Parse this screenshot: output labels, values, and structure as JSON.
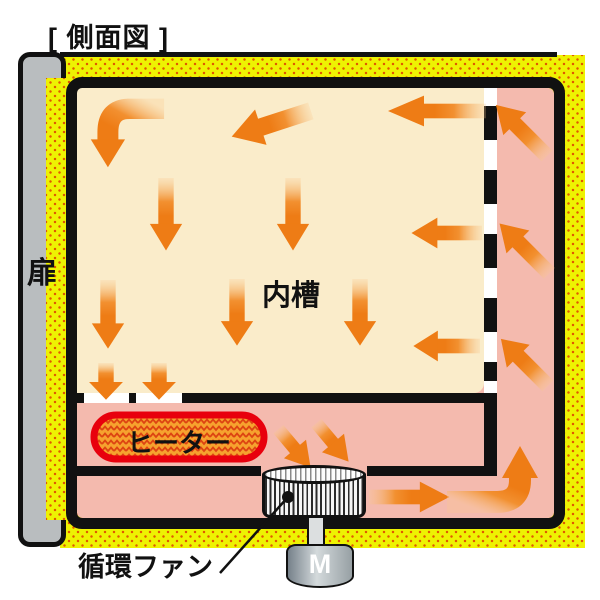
{
  "title": "[ 側面図 ]",
  "labels": {
    "door": "扉",
    "chamber": "内槽",
    "heater": "ヒーター",
    "fan": "循環ファン",
    "motor": "M"
  },
  "colors": {
    "insulation_yellow": "#eef202",
    "insulation_dot_orange": "#e05a00",
    "chamber_cream": "#faecca",
    "air_channel_pink": "#f4baae",
    "arrow_orange": "#ee7c15",
    "arrow_tail_light": "#f9c98e",
    "heater_fill_orange": "#f6a22e",
    "heater_hatch_red": "#dd4412",
    "heater_border_red": "#e8000d",
    "door_gray": "#b9bdbf",
    "wall_black": "#111111",
    "motor_gray": "#97a0a4"
  },
  "arrows": [
    {
      "kind": "bendLD",
      "x": 86,
      "y": 93,
      "w": 80,
      "h": 78,
      "rot": 0
    },
    {
      "kind": "s",
      "cx": 270,
      "cy": 124,
      "len": 85,
      "wid": 46,
      "rot": 162
    },
    {
      "kind": "s",
      "cx": 436,
      "cy": 111,
      "len": 100,
      "wid": 38,
      "rot": 180
    },
    {
      "kind": "s",
      "cx": 166,
      "cy": 215,
      "len": 74,
      "wid": 40,
      "rot": 90
    },
    {
      "kind": "s",
      "cx": 293,
      "cy": 215,
      "len": 74,
      "wid": 40,
      "rot": 90
    },
    {
      "kind": "s",
      "cx": 108,
      "cy": 315,
      "len": 70,
      "wid": 40,
      "rot": 90
    },
    {
      "kind": "s",
      "cx": 237,
      "cy": 313,
      "len": 68,
      "wid": 40,
      "rot": 90
    },
    {
      "kind": "s",
      "cx": 360,
      "cy": 313,
      "len": 68,
      "wid": 40,
      "rot": 90
    },
    {
      "kind": "ss",
      "cx": 106,
      "cy": 382,
      "len": 38,
      "wid": 40,
      "rot": 90
    },
    {
      "kind": "ss",
      "cx": 159,
      "cy": 382,
      "len": 38,
      "wid": 40,
      "rot": 90
    },
    {
      "kind": "s",
      "cx": 446,
      "cy": 233,
      "len": 72,
      "wid": 38,
      "rot": 180
    },
    {
      "kind": "s",
      "cx": 446,
      "cy": 346,
      "len": 68,
      "wid": 38,
      "rot": 180
    },
    {
      "kind": "s",
      "cx": 521,
      "cy": 130,
      "len": 74,
      "wid": 40,
      "rot": 225
    },
    {
      "kind": "s",
      "cx": 524,
      "cy": 248,
      "len": 72,
      "wid": 40,
      "rot": 225
    },
    {
      "kind": "s",
      "cx": 524,
      "cy": 362,
      "len": 68,
      "wid": 40,
      "rot": 225
    },
    {
      "kind": "ss",
      "cx": 295,
      "cy": 449,
      "len": 52,
      "wid": 34,
      "rot": 50
    },
    {
      "kind": "ss",
      "cx": 333,
      "cy": 443,
      "len": 52,
      "wid": 34,
      "rot": 50
    },
    {
      "kind": "s",
      "cx": 410,
      "cy": 497,
      "len": 82,
      "wid": 38,
      "rot": 0
    },
    {
      "kind": "bendRU",
      "x": 445,
      "y": 440,
      "w": 100,
      "h": 76,
      "rot": 0
    }
  ]
}
